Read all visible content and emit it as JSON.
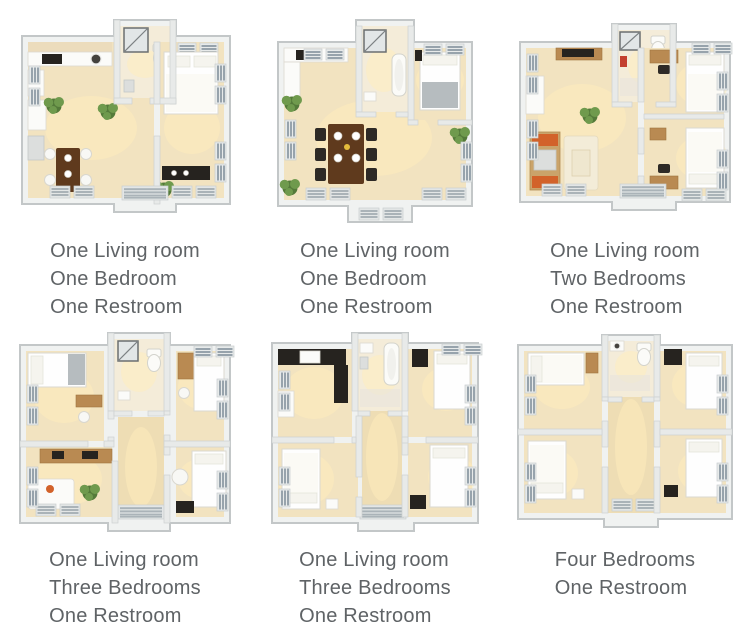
{
  "palette": {
    "background": "#ffffff",
    "caption_color": "#5f6366",
    "floor": "#f2e3c0",
    "floor_bath": "#f4ecd9",
    "floor_hall": "#eeddb4",
    "wall_face": "#f0f2f1",
    "wall_edge": "#c3c7c8",
    "iwall_face": "#e8eae9",
    "iwall_edge": "#ced1d1",
    "vent_slat": "#97a3ac",
    "vent_frame": "#e7eaea",
    "wood_dark": "#5f3a1d",
    "wood_light": "#b98a52",
    "counter_dark": "#26231f",
    "plant_dark": "#547a3a",
    "plant_light": "#6f9a4d",
    "accent_orange": "#d2622a",
    "accent_red": "#c3402e",
    "blanket_gray": "#b6bcbf",
    "white_furniture": "#fbfbf9",
    "glow": "#ffeebb"
  },
  "cards": [
    {
      "caption_lines": [
        "One Living room",
        "One Bedroom",
        "One Restroom"
      ]
    },
    {
      "caption_lines": [
        "One Living room",
        "One Bedroom",
        "One Restroom"
      ]
    },
    {
      "caption_lines": [
        "One Living room",
        "Two Bedrooms",
        "One Restroom"
      ]
    },
    {
      "caption_lines": [
        "One Living room",
        "Three Bedrooms",
        "One Restroom"
      ]
    },
    {
      "caption_lines": [
        "One Living room",
        "Three Bedrooms",
        "One Restroom"
      ]
    },
    {
      "caption_lines": [
        "Four Bedrooms",
        "One Restroom"
      ]
    }
  ]
}
